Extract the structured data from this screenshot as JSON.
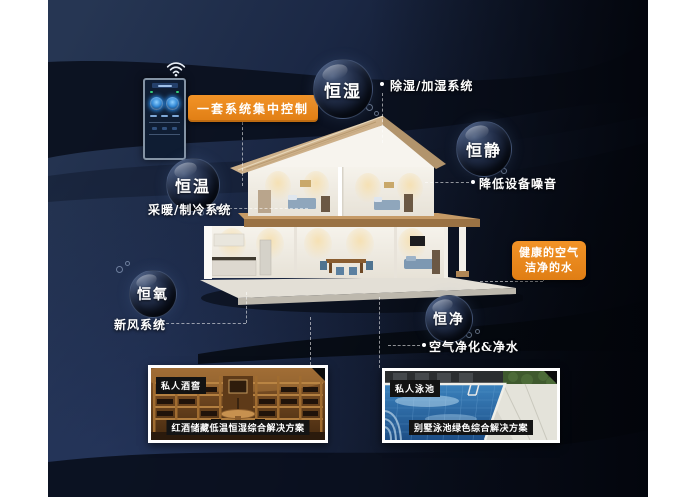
{
  "control_panel": {
    "label": "一套系统集中控制"
  },
  "bubbles": [
    {
      "label": "恒湿",
      "note": "除湿/加湿系统"
    },
    {
      "label": "恒静",
      "note": "降低设备噪音"
    },
    {
      "label": "恒温",
      "note": "采暖/制冷系统"
    },
    {
      "label": "恒氧",
      "note": "新风系统"
    },
    {
      "label": "恒净",
      "note": "空气净化&净水"
    }
  ],
  "highlight_box": {
    "line1": "健康的空气",
    "line2": "洁净的水"
  },
  "cards": [
    {
      "tag": "私人酒窖",
      "caption": "红酒储藏低温恒湿综合解决方案"
    },
    {
      "tag": "私人泳池",
      "caption": "别墅泳池绿色综合解决方案"
    }
  ],
  "colors": {
    "accent_orange": "#ea861d",
    "background_navy": "#1c2a47",
    "wave_dark": "#0a0f1c",
    "bubble_dark": "#0d1526",
    "pool_blue": "#2e6fa8",
    "wood_tan": "#b07c3e"
  }
}
